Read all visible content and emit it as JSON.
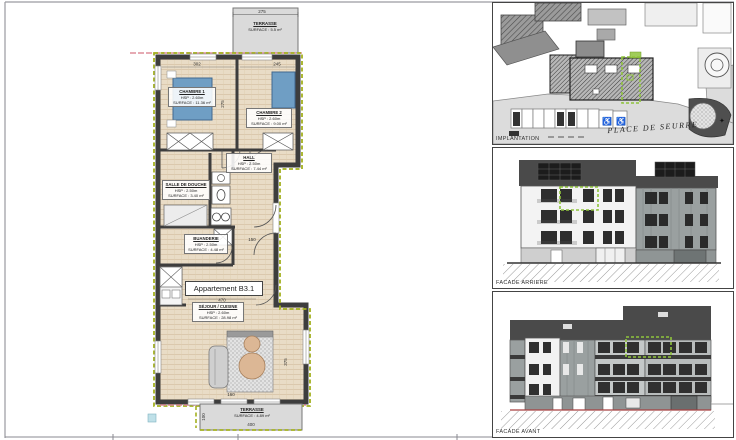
{
  "drawing": {
    "title": "Appartement B3.1",
    "rooms": [
      {
        "name": "CHAMBRE 1",
        "hsp": "HSP : 2.60m",
        "surface": "SURFACE : 11.36 m²"
      },
      {
        "name": "CHAMBRE 2",
        "hsp": "HSP : 2.60m",
        "surface": "SURFACE : 9.00 m²"
      },
      {
        "name": "HALL",
        "hsp": "HSP : 2.50m",
        "surface": "SURFACE : 7.44 m²"
      },
      {
        "name": "SALLE DE DOUCHE",
        "hsp": "HSP : 2.50m",
        "surface": "SURFACE : 3.40 m²"
      },
      {
        "name": "BUANDERIE",
        "hsp": "HSP : 2.50m",
        "surface": "SURFACE : 4.48 m²"
      },
      {
        "name": "SÉJOUR / CUISINE",
        "hsp": "HSP : 2.60m",
        "surface": "SURFACE : 28.98 m²"
      }
    ],
    "terrace_top": {
      "name": "TERRASSE",
      "surface": "SURFACE : 5.5 m²"
    },
    "terrace_bottom": {
      "name": "TERRASSE",
      "surface": "SURFACE : 4.89 m²"
    },
    "dims": {
      "terrace_top_w": "275",
      "chambre1_w": "302",
      "chambre2_w": "245",
      "bedrooms_h": "275",
      "hall_w": "150",
      "title_w": "470",
      "sejour_h": "375",
      "sejour_w": "160",
      "terrace_bottom_w": "400",
      "terrace_bottom_h": "100"
    }
  },
  "panels": [
    {
      "label": "IMPLANTATION",
      "street": "PLACE DE SEURRE"
    },
    {
      "label": "FACADE ARRIERE"
    },
    {
      "label": "FACADE AVANT"
    }
  ],
  "colors": {
    "highlight_green": "#8fc43c",
    "insulation_olive": "#a3b11f",
    "wall_dark": "#3d3d3d",
    "floor_wood": "#e9dcc6",
    "bed_blue": "#6f9ec4",
    "terrace_gray": "#dadada",
    "roof_dark": "#4a4a4a",
    "accent_pink": "#dd8e9a"
  }
}
